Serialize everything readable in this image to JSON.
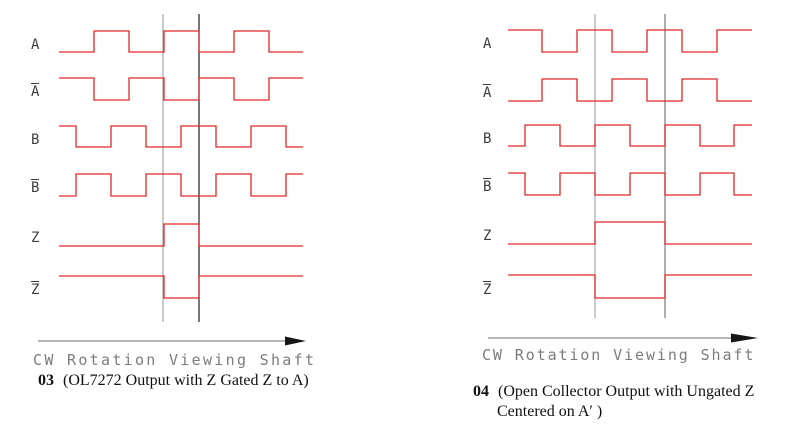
{
  "page": {
    "background": "#ffffff",
    "wave_color": "#e12728",
    "label_color": "#3d3d3d",
    "axis_text_color": "#7c7c7c",
    "arrow_line_color": "#8c8c8c",
    "arrow_head_color": "#151515"
  },
  "diagrams": [
    {
      "id": "left",
      "axis_label": "CW Rotation Viewing Shaft",
      "caption": {
        "number": "03",
        "line1": "(OL7272 Output with Z Gated Z to A)",
        "line2": ""
      },
      "x_start": 59,
      "x_end": 303,
      "label_x": 31,
      "signals": [
        {
          "label": "A",
          "overbar": false,
          "y_high": 31,
          "y_low": 52,
          "init": "low",
          "edges": [
            94,
            129,
            164,
            199,
            234,
            269
          ]
        },
        {
          "label": "A",
          "overbar": true,
          "y_high": 78,
          "y_low": 100,
          "init": "high",
          "edges": [
            94,
            129,
            164,
            199,
            234,
            269
          ]
        },
        {
          "label": "B",
          "overbar": false,
          "y_high": 126,
          "y_low": 147,
          "init": "high",
          "edges": [
            76,
            111,
            146,
            181,
            216,
            251,
            286
          ]
        },
        {
          "label": "B",
          "overbar": true,
          "y_high": 174,
          "y_low": 196,
          "init": "low",
          "edges": [
            76,
            111,
            146,
            181,
            216,
            251,
            286
          ]
        },
        {
          "label": "Z",
          "overbar": false,
          "y_high": 224,
          "y_low": 246,
          "init": "low",
          "edges": [
            164,
            199
          ]
        },
        {
          "label": "Z",
          "overbar": true,
          "y_high": 276,
          "y_low": 298,
          "init": "high",
          "edges": [
            164,
            199
          ]
        }
      ],
      "markers": [
        {
          "x": 163,
          "y1": 14,
          "y2": 322,
          "color": "#a6a6a6"
        },
        {
          "x": 199,
          "y1": 14,
          "y2": 322,
          "color": "#1f1f1f"
        }
      ],
      "arrow": {
        "x1": 38,
        "x2": 285,
        "tip": 306,
        "y": 341,
        "head_h": 9
      },
      "axis_text": {
        "x": 33,
        "y": 351,
        "spacing": 2.3
      },
      "caption_pos": {
        "x": 38,
        "y": 371
      }
    },
    {
      "id": "right",
      "axis_label": "CW Rotation Viewing Shaft",
      "caption": {
        "number": "04",
        "line1": "(Open Collector Output with Ungated Z",
        "line2": "Centered on A′ )"
      },
      "x_start": 508,
      "x_end": 752,
      "label_x": 483,
      "signals": [
        {
          "label": "A",
          "overbar": false,
          "y_high": 30,
          "y_low": 52,
          "init": "high",
          "edges": [
            542,
            577,
            612,
            647,
            682,
            717
          ]
        },
        {
          "label": "A",
          "overbar": true,
          "y_high": 79,
          "y_low": 101,
          "init": "low",
          "edges": [
            542,
            577,
            612,
            647,
            682,
            717
          ]
        },
        {
          "label": "B",
          "overbar": false,
          "y_high": 125,
          "y_low": 146,
          "init": "low",
          "edges": [
            525,
            560,
            595,
            630,
            665,
            700,
            734
          ]
        },
        {
          "label": "B",
          "overbar": true,
          "y_high": 173,
          "y_low": 195,
          "init": "high",
          "edges": [
            525,
            560,
            595,
            630,
            665,
            700,
            734
          ]
        },
        {
          "label": "Z",
          "overbar": false,
          "y_high": 222,
          "y_low": 244,
          "init": "low",
          "edges": [
            595,
            665
          ]
        },
        {
          "label": "Z",
          "overbar": true,
          "y_high": 275,
          "y_low": 298,
          "init": "high",
          "edges": [
            595,
            665
          ]
        }
      ],
      "markers": [
        {
          "x": 595,
          "y1": 14,
          "y2": 318,
          "color": "#a9a9a9"
        },
        {
          "x": 665,
          "y1": 14,
          "y2": 318,
          "color": "#787878"
        }
      ],
      "arrow": {
        "x1": 488,
        "x2": 731,
        "tip": 758,
        "y": 338,
        "head_h": 9
      },
      "axis_text": {
        "x": 482,
        "y": 346,
        "spacing": 1.9
      },
      "caption_pos": {
        "x": 473,
        "y": 382
      }
    }
  ]
}
